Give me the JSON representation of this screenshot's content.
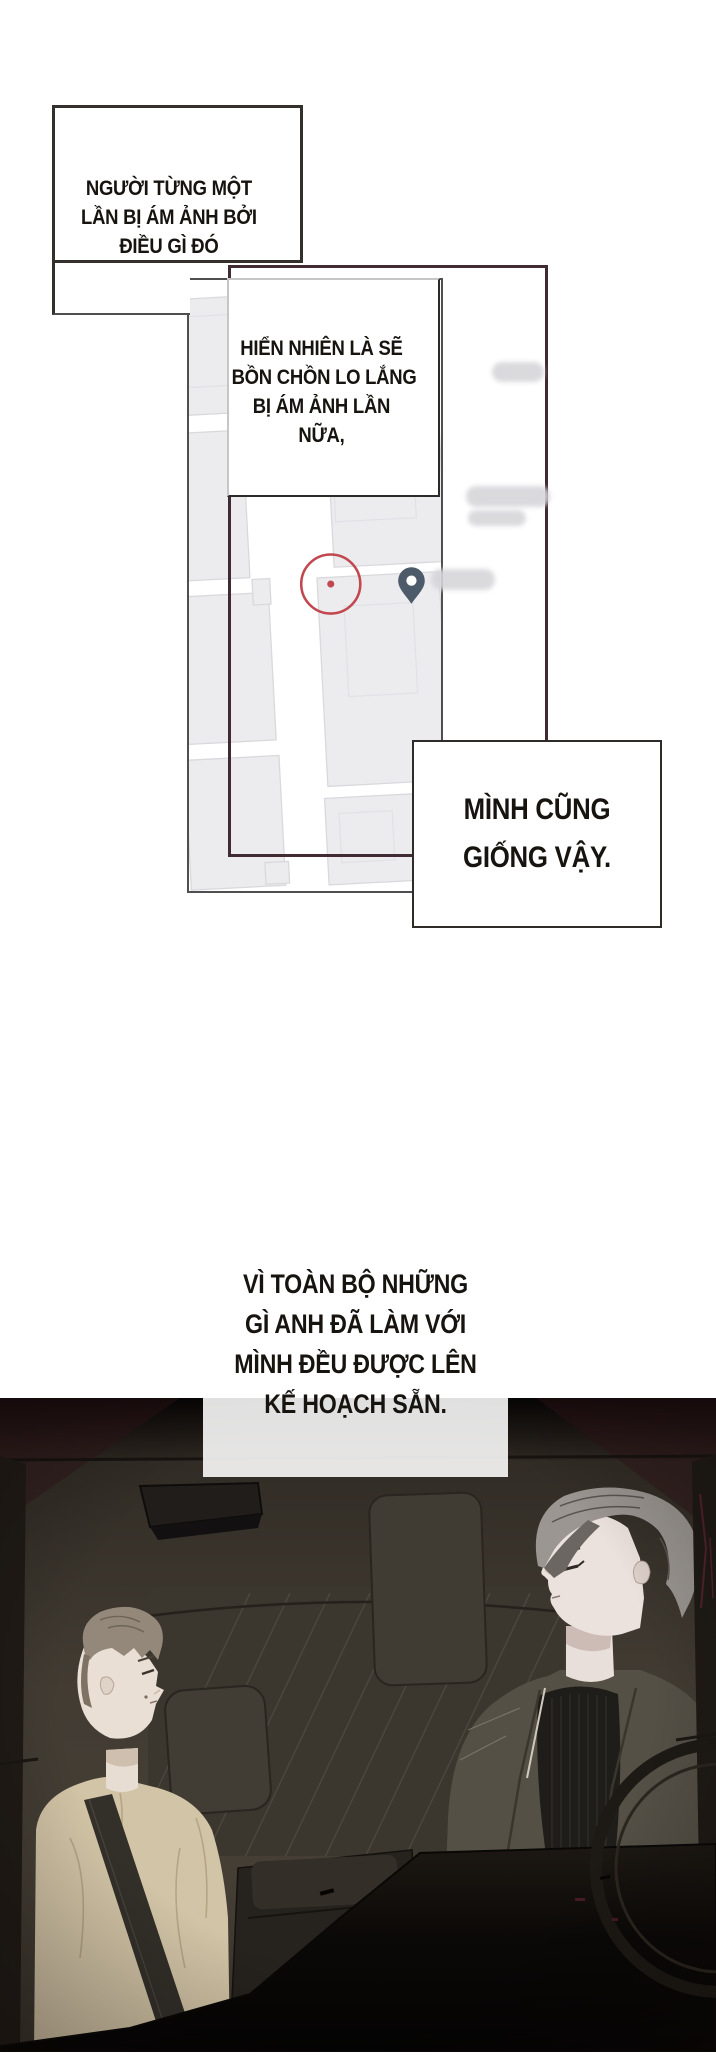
{
  "page": {
    "width": 716,
    "height": 2059,
    "background": "#ffffff"
  },
  "colors": {
    "panel_border_dark": "#34302b",
    "offset_frame_maroon": "#402b33",
    "map_photo_border": "#4f4f4f",
    "map_building_fill": "#ececef",
    "map_building_stroke": "#d9d9dd",
    "map_road": "#ffffff",
    "marker_circle_red": "#c1484f",
    "location_pin": "#4c5a69",
    "redacted_blur_gray": "#d6d6da",
    "car_cabin": "#423c33",
    "car_dashboard": "#0b0907",
    "passenger_shirt": "#d2c4a6",
    "driver_jacket": "#555046",
    "driver_turtleneck": "#1f1d1a"
  },
  "boxes": [
    {
      "name": "narration-box-1",
      "lines": [
        "NGƯỜI TỪNG MỘT",
        "LẦN BỊ ÁM ẢNH BỞI",
        "ĐIỀU GÌ ĐÓ"
      ]
    },
    {
      "name": "narration-box-2",
      "lines": [
        "HIỂN NHIÊN LÀ SẼ",
        "BỒN CHỒN LO LẮNG",
        "BỊ ÁM ẢNH LẦN",
        "NỮA,"
      ]
    },
    {
      "name": "narration-box-3",
      "lines": [
        "MÌNH CŨNG",
        "GIỐNG VẬY."
      ]
    },
    {
      "name": "narration-box-4",
      "lines": [
        "VÌ TOÀN BỘ NHỮNG",
        "GÌ ANH ĐÃ LÀM VỚI",
        "MÌNH ĐỀU ĐƯỢC LÊN",
        "KẾ HOẠCH SẴN."
      ]
    }
  ],
  "map": {
    "marker_circle": {
      "cx": 331,
      "cy": 584,
      "r": 30
    },
    "pin": {
      "cx": 413,
      "cy": 584
    },
    "redacted_blob_count": 4
  }
}
